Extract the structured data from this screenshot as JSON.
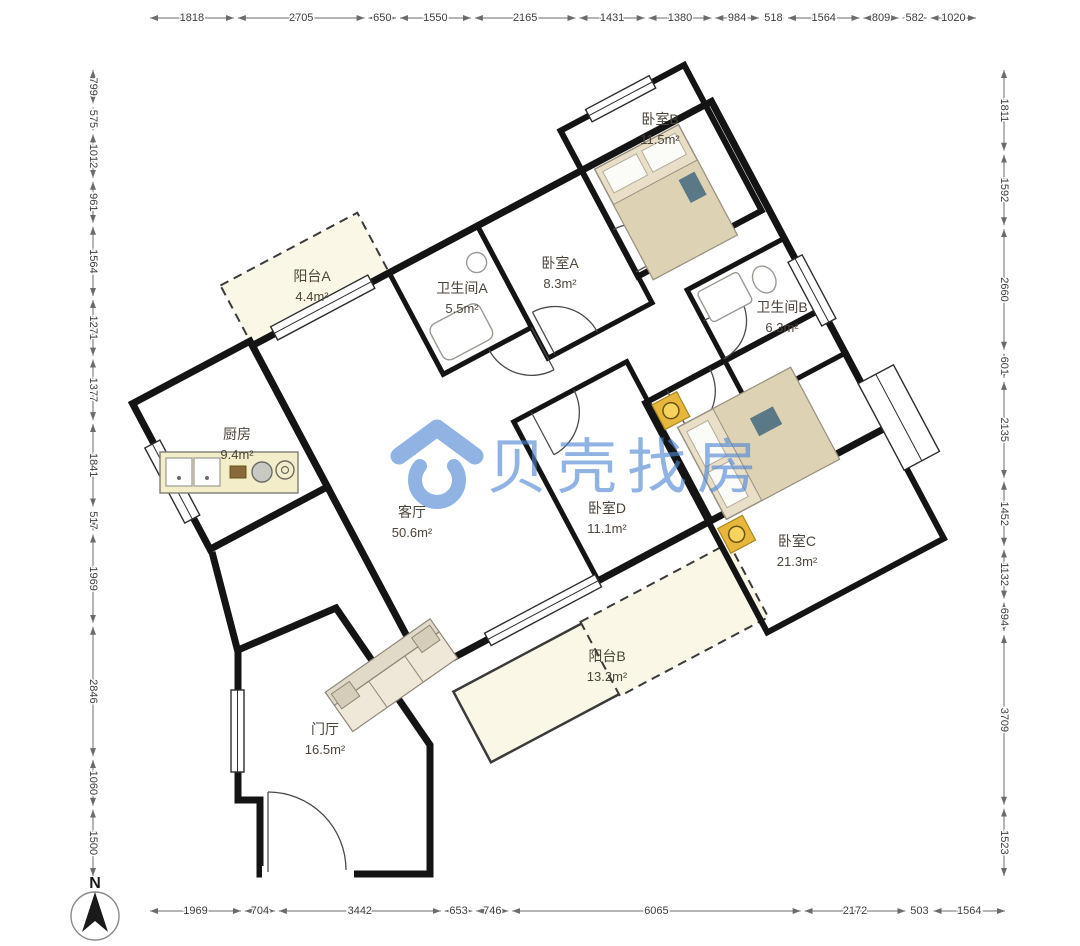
{
  "watermark": {
    "text": "贝壳找房"
  },
  "compass": {
    "label": "N"
  },
  "rooms": [
    {
      "id": "bedroom-b",
      "name": "卧室B",
      "area": "11.5m²",
      "x": 660,
      "y": 124
    },
    {
      "id": "bedroom-a",
      "name": "卧室A",
      "area": "8.3m²",
      "x": 560,
      "y": 268
    },
    {
      "id": "bathroom-a",
      "name": "卫生间A",
      "area": "5.5m²",
      "x": 462,
      "y": 293
    },
    {
      "id": "balcony-a",
      "name": "阳台A",
      "area": "4.4m²",
      "x": 312,
      "y": 281
    },
    {
      "id": "bathroom-b",
      "name": "卫生间B",
      "area": "6.3m²",
      "x": 782,
      "y": 312
    },
    {
      "id": "kitchen",
      "name": "厨房",
      "area": "9.4m²",
      "x": 237,
      "y": 439
    },
    {
      "id": "living-room",
      "name": "客厅",
      "area": "50.6m²",
      "x": 412,
      "y": 517
    },
    {
      "id": "bedroom-d",
      "name": "卧室D",
      "area": "11.1m²",
      "x": 607,
      "y": 513
    },
    {
      "id": "bedroom-c",
      "name": "卧室C",
      "area": "21.3m²",
      "x": 797,
      "y": 546
    },
    {
      "id": "balcony-b",
      "name": "阳台B",
      "area": "13.2m²",
      "x": 607,
      "y": 661
    },
    {
      "id": "entry-hall",
      "name": "门厅",
      "area": "16.5m²",
      "x": 325,
      "y": 734
    }
  ],
  "dimensions_mm": {
    "top": [
      1818,
      2705,
      650,
      1550,
      2165,
      1431,
      1380,
      984,
      518,
      1564,
      809,
      582,
      1020
    ],
    "bottom": [
      1969,
      704,
      3442,
      653,
      746,
      6065,
      2172,
      503,
      1564
    ],
    "left": [
      799,
      575,
      1012,
      961,
      1564,
      1271,
      1377,
      1841,
      517,
      1969,
      2846,
      1060,
      1500
    ],
    "right": [
      1811,
      1592,
      2660,
      601,
      2135,
      1452,
      1132,
      694,
      3709,
      1523
    ]
  },
  "colors": {
    "brand_blue": "#4E86D5",
    "wall": "#141414",
    "wood_floor": "#ECC88B",
    "tile_floor": "#F8EBC8",
    "bath_floor": "#F1F0EC",
    "balcony_floor": "#FBF7E6",
    "dim_text": "#3D3D3D",
    "label_text": "#4C4339"
  }
}
